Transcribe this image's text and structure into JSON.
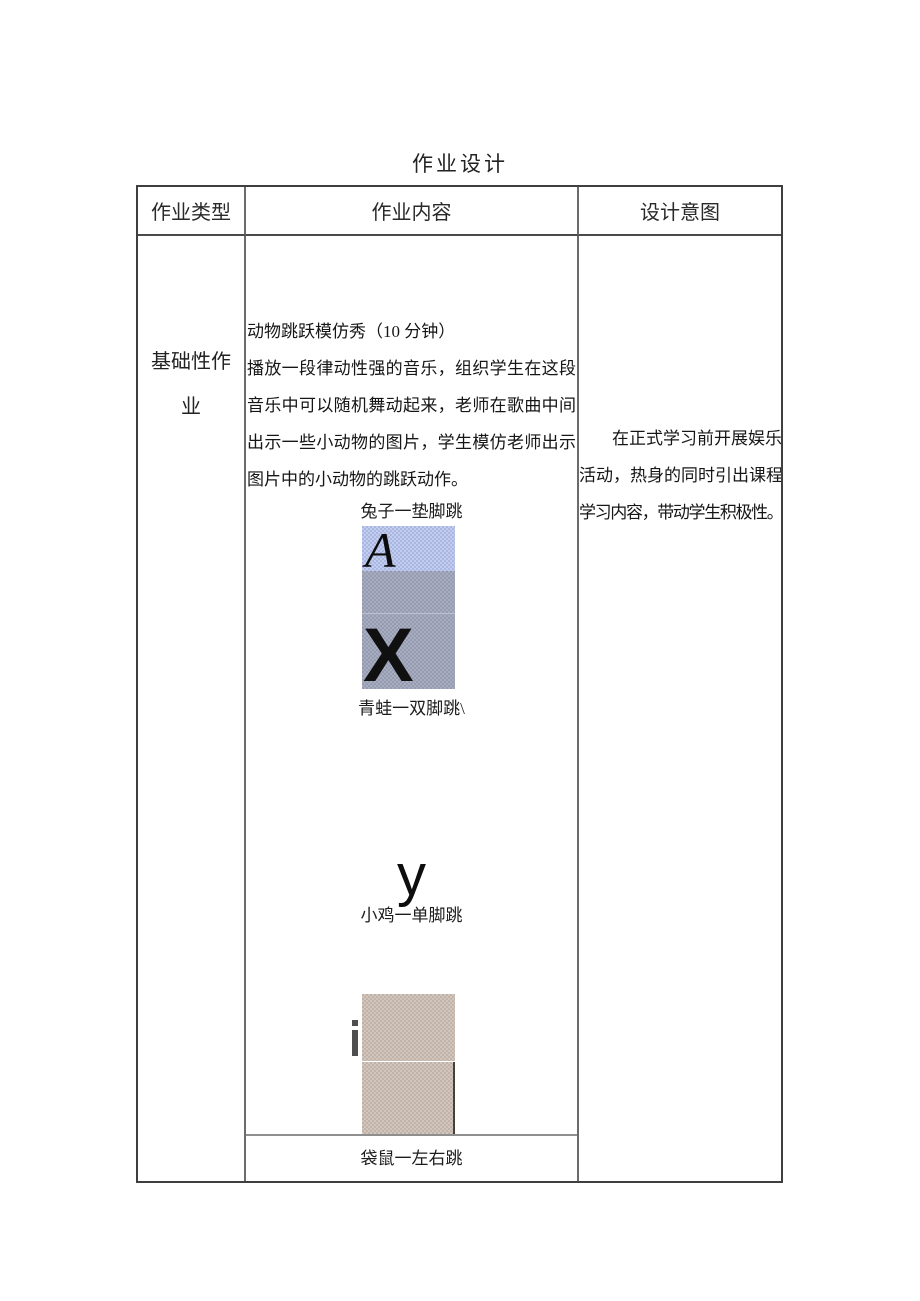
{
  "page_title": "作业设计",
  "table": {
    "headers": [
      "作业类型",
      "作业内容",
      "设计意图"
    ],
    "row": {
      "type_label": "基础性作业",
      "content": {
        "heading": "动物跳跃模仿秀（10 分钟）",
        "body_lines": [
          "播放一段律动性强的音乐，组织学生在这段",
          "音乐中可以随机舞动起来，老师在歌曲中间",
          "出示一些小动物的图片，学生模仿老师出示",
          "图片中的小动物的跳跃动作。"
        ],
        "figures": {
          "rabbit": {
            "caption": "兔子一垫脚跳",
            "letter_top": "A",
            "letter_bottom": "X",
            "top_color": "#b7c2e6",
            "bottom_color": "#9fa6ba"
          },
          "frog": {
            "caption": "青蛙一双脚跳\\"
          },
          "chick": {
            "letter": "y",
            "caption": "小鸡一单脚跳"
          },
          "kangaroo": {
            "letter": "i",
            "caption": "袋鼠一左右跳",
            "color": "#c9bcb2"
          }
        }
      },
      "intent_lines": [
        "在正式学习前开展娱乐",
        "活动，热身的同时引出课程",
        "学习内容，带动学生积极性。"
      ]
    }
  }
}
